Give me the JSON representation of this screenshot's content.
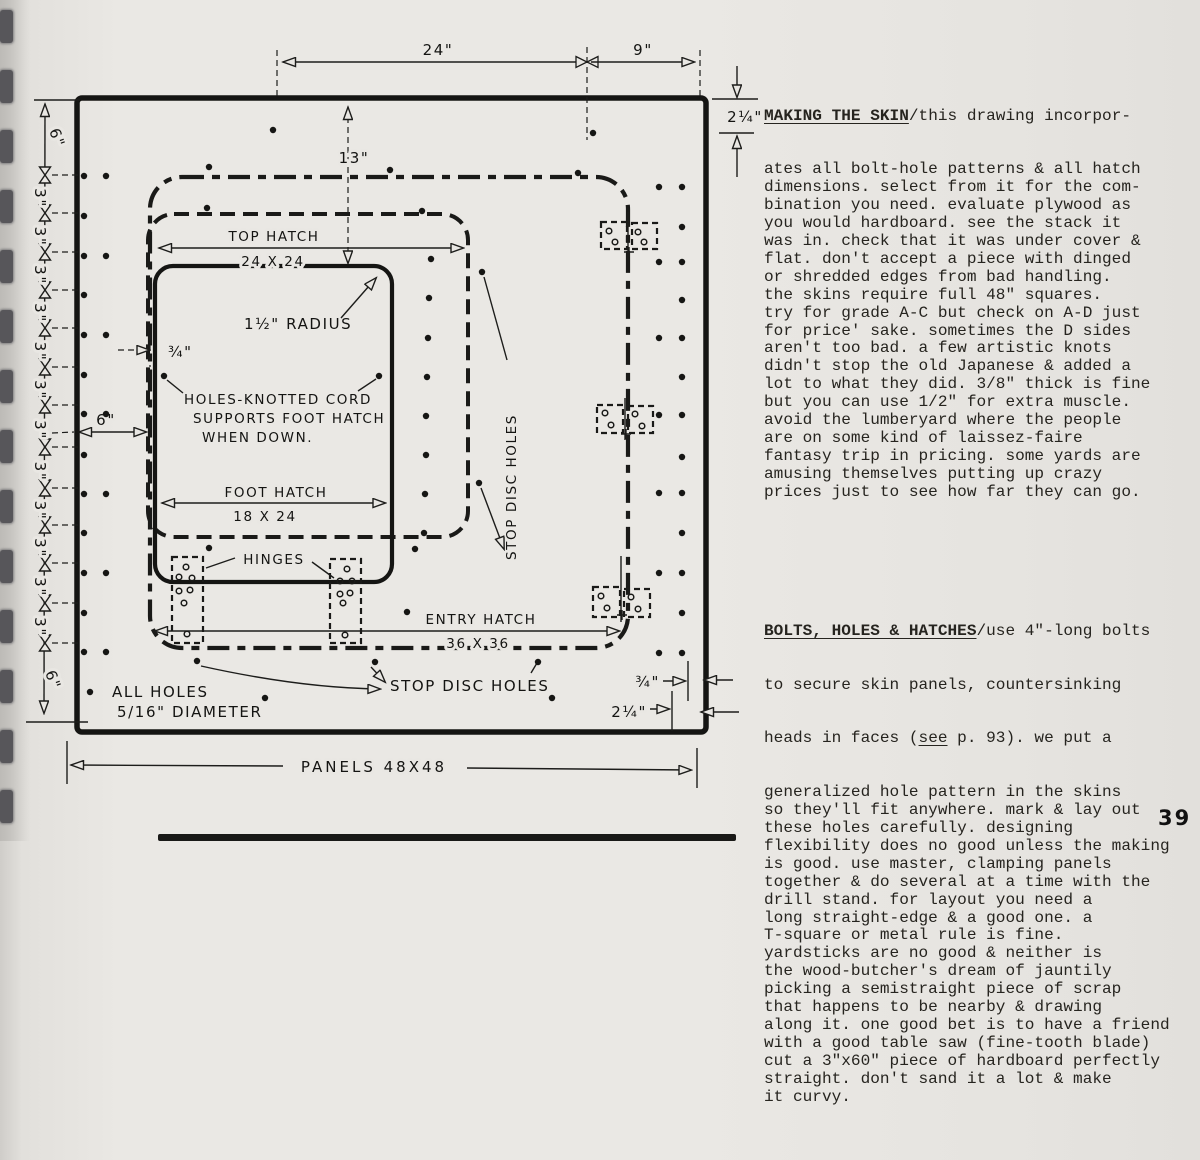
{
  "page": {
    "number": "39"
  },
  "colors": {
    "paper": "#e9e7e3",
    "ink": "#1d1d1b"
  },
  "article": {
    "para1": {
      "title": "MAKING THE SKIN",
      "after_title": "/this drawing incorpor-",
      "lines": [
        "ates all bolt-hole patterns & all hatch",
        "dimensions. select from it for the com-",
        "bination you need. evaluate plywood as",
        "you would hardboard. see the stack it",
        "was in. check that it was under cover &",
        "flat. don't accept a piece with dinged",
        "or shredded edges from bad handling.",
        "the skins require full 48\" squares.",
        "try for grade A-C but check on A-D just",
        "for price' sake. sometimes the D sides",
        "aren't too bad. a few artistic knots",
        "didn't stop the old Japanese & added a",
        "lot to what they did. 3/8\" thick is fine",
        "but you can use 1/2\" for extra muscle.",
        "avoid the lumberyard where the people",
        "are on some kind of laissez-faire",
        "fantasy trip in pricing. some yards are",
        "amusing themselves putting up crazy",
        "prices just to see how far they can go."
      ]
    },
    "para2": {
      "title": "BOLTS, HOLES & HATCHES",
      "after_title": "/use 4\"-long bolts",
      "lines_a": [
        "to secure skin panels, countersinking"
      ],
      "see_line": {
        "pre": "heads in faces (",
        "see": "see",
        "post": " p. 93). we put a"
      },
      "lines_b": [
        "generalized hole pattern in the skins",
        "so they'll fit anywhere. mark & lay out",
        "these holes carefully. designing",
        "flexibility does no good unless the making",
        "is good. use master, clamping panels",
        "together & do several at a time with the",
        "drill stand. for layout you need a",
        "long straight-edge & a good one. a",
        "T-square or metal rule is fine.",
        "yardsticks are no good & neither is",
        "the wood-butcher's dream of jauntily",
        "picking a semistraight piece of scrap",
        "that happens to be nearby & drawing",
        "along it. one good bet is to have a friend",
        "with a good table saw (fine-tooth blade)",
        "cut a 3\"x60\" piece of hardboard perfectly",
        "straight. don't sand it a lot & make",
        "it curvy."
      ]
    }
  },
  "diagram": {
    "dims": {
      "top24": "24\"",
      "top9": "9\"",
      "v13": "13\"",
      "tr214": "2¼\"",
      "left6top": "6\"",
      "three": "3\"",
      "left6bot": "6\"",
      "mid6": "6\"",
      "ul34": "¾\"",
      "radius": "1½\" RADIUS",
      "br34": "¾\"",
      "br214": "2¼\""
    },
    "labels": {
      "top_hatch1": "TOP HATCH",
      "top_hatch2": "24 X 24",
      "foot_hatch1": "FOOT HATCH",
      "foot_hatch2": "18 X 24",
      "entry_hatch1": "ENTRY HATCH",
      "entry_hatch2": "36 X 36",
      "hinges": "HINGES",
      "knotted1": "HOLES-KNOTTED CORD",
      "knotted2": "SUPPORTS FOOT HATCH",
      "knotted3": "WHEN DOWN.",
      "stop_disc_vert": "STOP DISC HOLES",
      "stop_disc_bottom": "STOP DISC HOLES",
      "all_holes1": "ALL HOLES",
      "all_holes2": "5/16\" DIAMETER",
      "panels": "PANELS 48X48"
    }
  }
}
